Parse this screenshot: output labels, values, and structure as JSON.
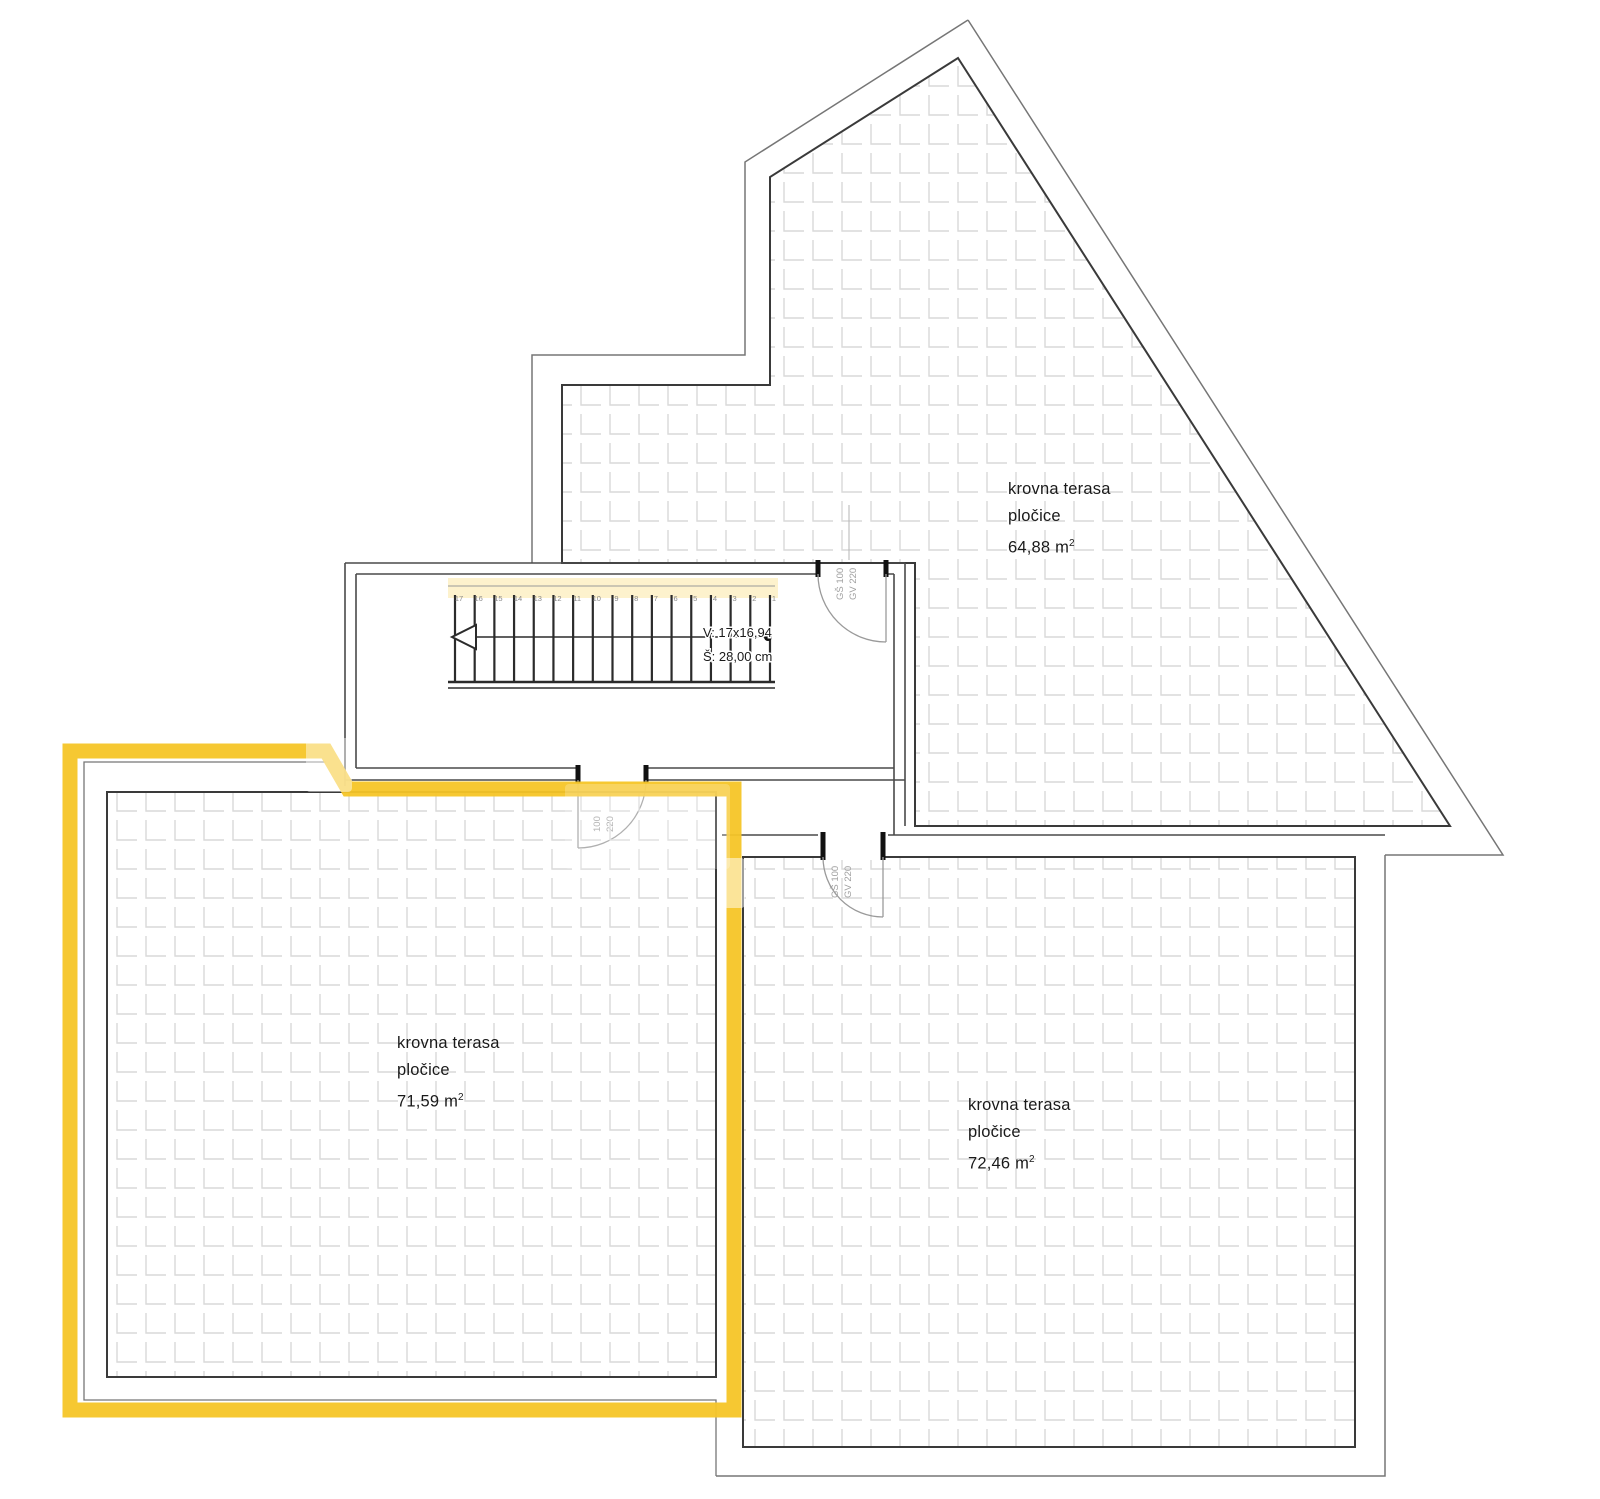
{
  "colors": {
    "highlight": "#F6C527",
    "highlight_soft": "#F7D14A",
    "wall": "#3a3a3a",
    "wall_thin": "#4a4a4a",
    "outline": "#767676",
    "tile_line": "#d9d9d9",
    "text": "#1a1a1a",
    "door_text": "#a0a0a0",
    "step_number": "#8a8a8a",
    "jamb": "#111111"
  },
  "terraces": {
    "top": {
      "line1": "krovna terasa",
      "line2": "pločice",
      "area": "64,88",
      "unit": " m",
      "sup": "2"
    },
    "left": {
      "line1": "krovna terasa",
      "line2": "pločice",
      "area": "71,59",
      "unit": " m",
      "sup": "2"
    },
    "bottom": {
      "line1": "krovna terasa",
      "line2": "pločice",
      "area": "72,46",
      "unit": " m",
      "sup": "2"
    }
  },
  "stairwell": {
    "dim_line1": "V: 17x16,94",
    "dim_line2": "Š: 28,00 cm",
    "step_numbers": [
      "17",
      "16",
      "15",
      "14",
      "13",
      "12",
      "11",
      "10",
      "9",
      "8",
      "7",
      "6",
      "5",
      "4",
      "3",
      "2",
      "1"
    ]
  },
  "doors": {
    "top_door": {
      "line1": "GŠ 100",
      "line2": "GV 220"
    },
    "left_door": {
      "line1": "100",
      "line2": "220"
    },
    "bottom_door": {
      "line1": "GŠ 100",
      "line2": "GV 220"
    }
  }
}
